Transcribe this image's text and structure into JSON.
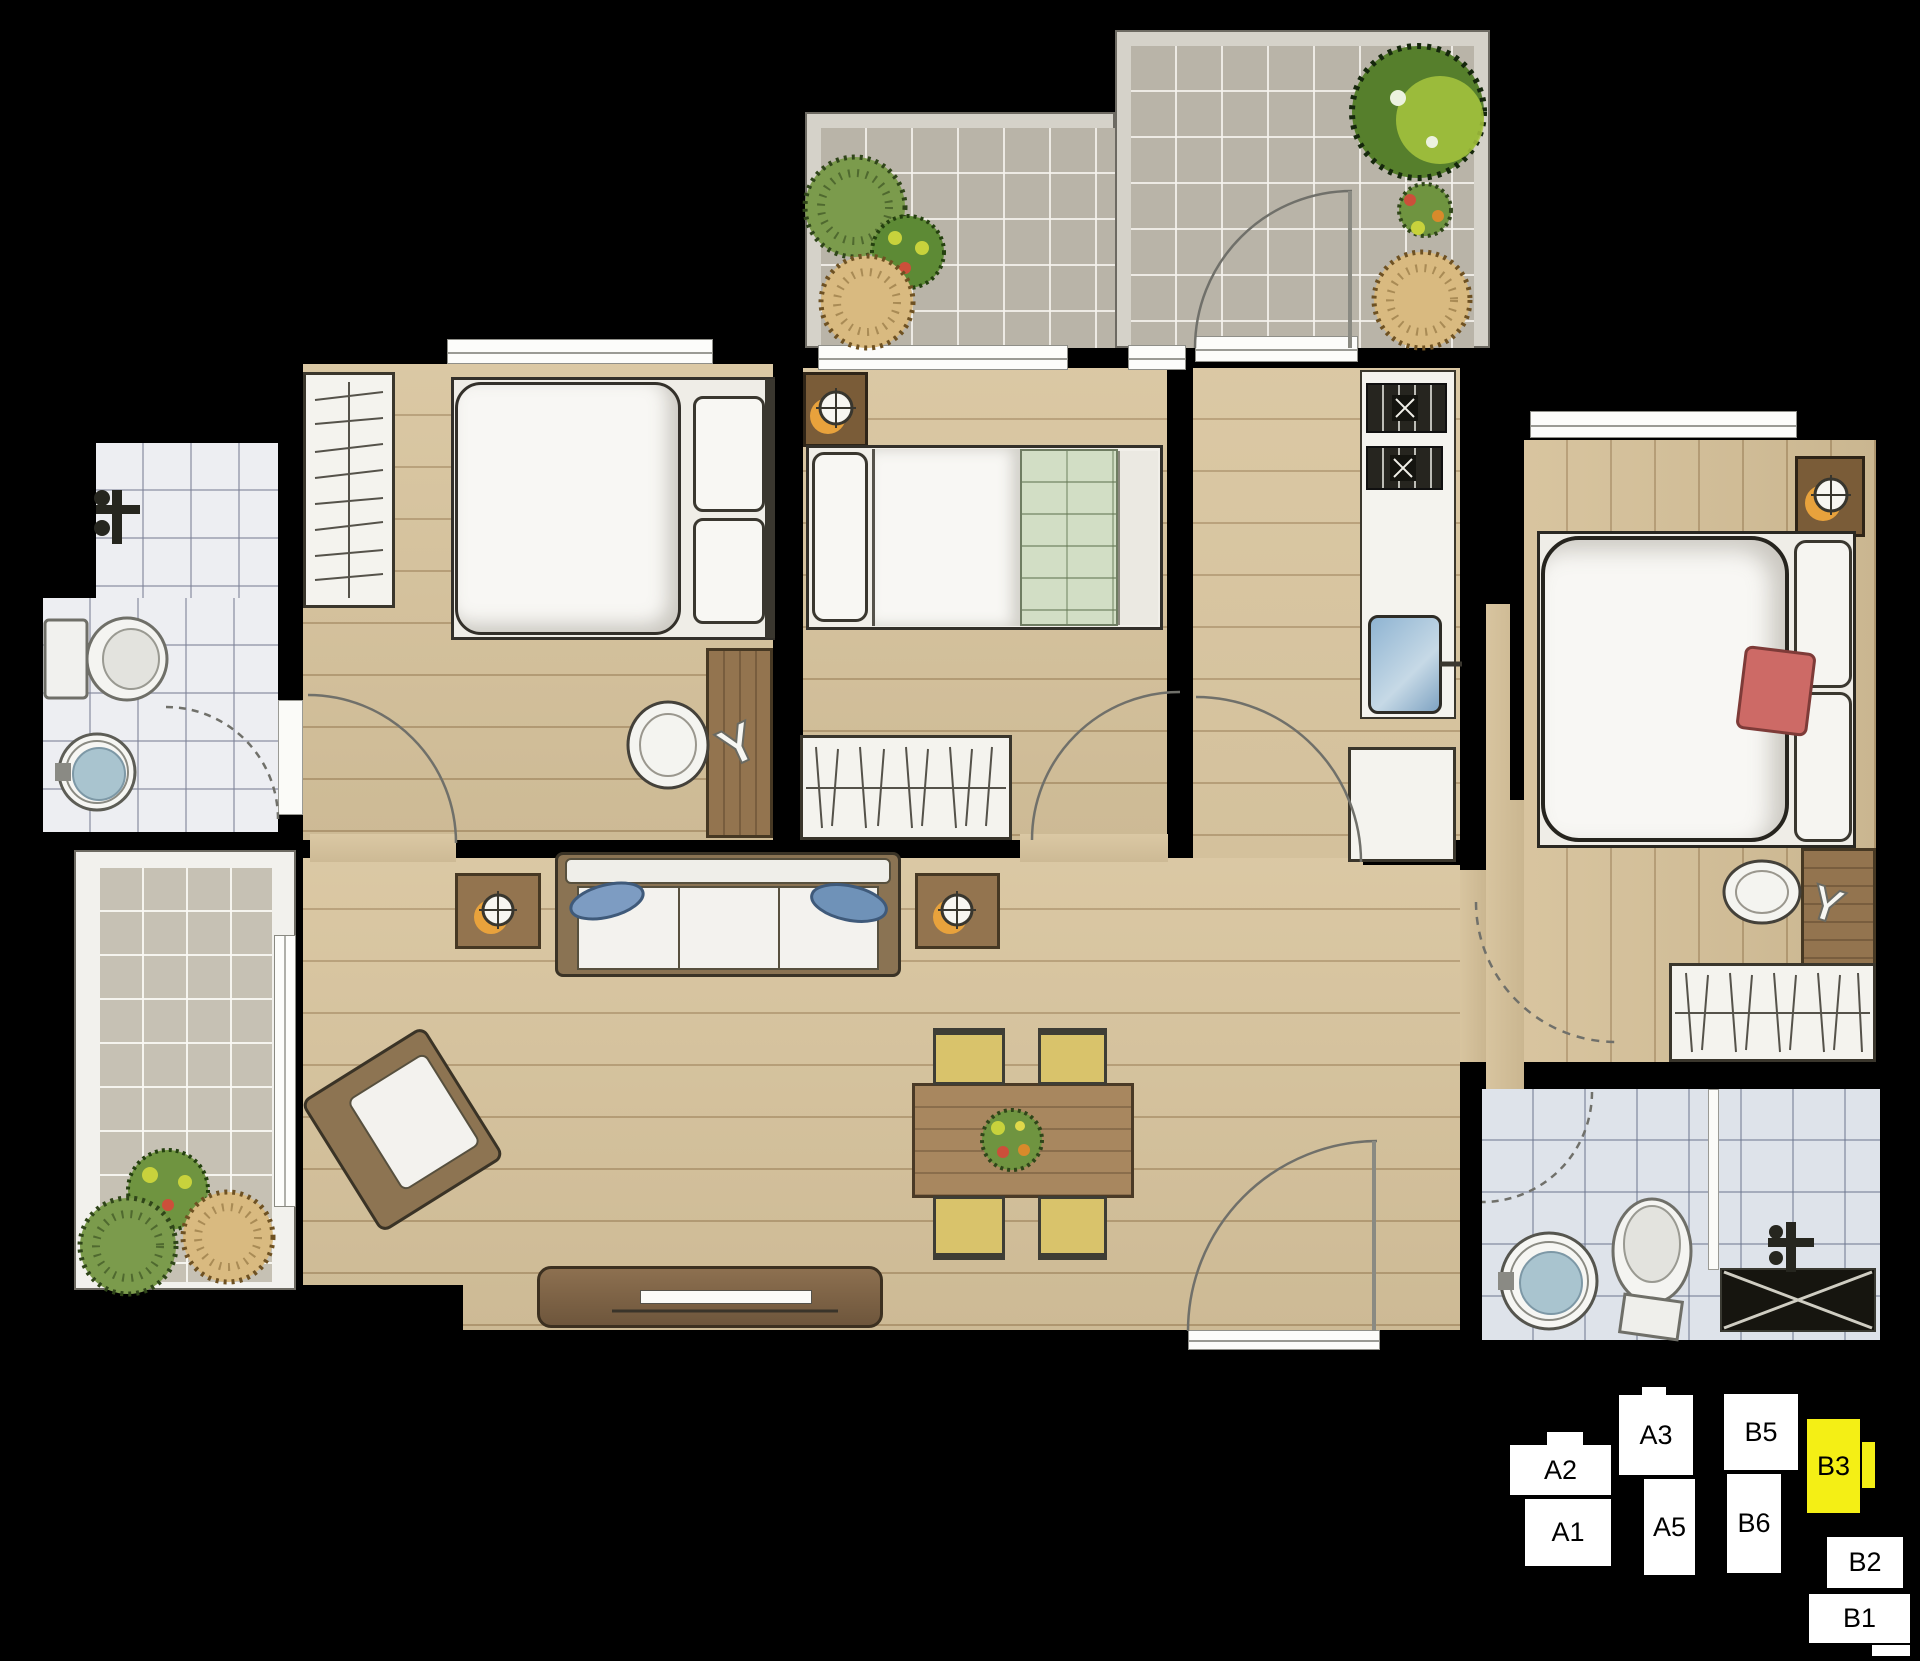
{
  "key_plan": {
    "highlighted_unit": "B3",
    "colors": {
      "unit_fill": "#ffffff",
      "highlight_fill": "#f4ef15",
      "outline": "#000000",
      "label_color": "#000000"
    },
    "units": [
      {
        "label": "A2"
      },
      {
        "label": "A3"
      },
      {
        "label": "B5"
      },
      {
        "label": "B3"
      },
      {
        "label": "A1"
      },
      {
        "label": "A5"
      },
      {
        "label": "B6"
      },
      {
        "label": "B2"
      },
      {
        "label": "B1"
      }
    ]
  },
  "floor_plan": {
    "rooms": [
      "terrace",
      "bedroom-1",
      "bedroom-2",
      "kitchen",
      "entry-hall",
      "living-dining-room",
      "master-bedroom",
      "hallway",
      "bathroom-1",
      "bathroom-2",
      "balcony"
    ],
    "furniture": [
      "double-bed",
      "single-bed",
      "master-bed",
      "wardrobe",
      "dressing-table",
      "stool",
      "nightstand-lamp",
      "side-table-lamp",
      "sofa",
      "armchair",
      "tv-console",
      "dining-table",
      "dining-chair",
      "kitchen-counter",
      "stove-burner",
      "kitchen-sink",
      "base-cabinet",
      "toilet",
      "pedestal-sink",
      "shower-mixer",
      "bath-mat",
      "planter-bush",
      "tree"
    ],
    "colors": {
      "background": "#000000",
      "wood_floor": "#d8c49d",
      "terrace_tile": "#b9b4a8",
      "bathroom_tile": "#edeef2",
      "bathroom2_tile": "#dee3ea",
      "balcony_tile": "#c6c1b4",
      "furniture_wood": "#93744f",
      "cushion_white": "#f4f3ee",
      "blanket_green": "#d2dec5",
      "pillow_red": "#cd6a66",
      "pillow_blue": "#7d9cc2",
      "chair_yellow": "#d9c36b",
      "sink_blue": "#a9c4cf",
      "lamp_glow": "#e8a23c"
    }
  }
}
